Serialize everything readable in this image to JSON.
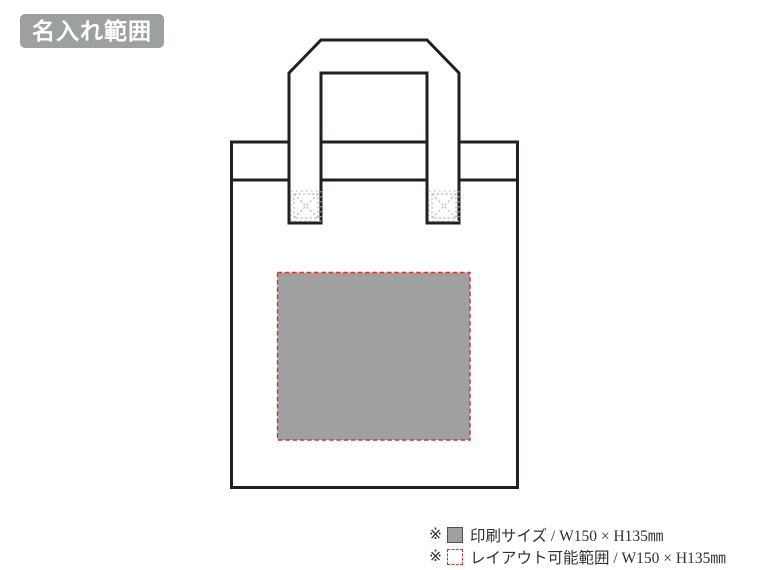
{
  "badge": {
    "label": "名入れ範囲"
  },
  "diagram": {
    "subject": "tote-bag",
    "colors": {
      "outline": "#231f20",
      "print_area_fill": "#a0a0a0",
      "layout_area_border": "#c9352e",
      "badge_background": "#9da0a0",
      "stitch_mark": "#bdbdbd"
    }
  },
  "legend": {
    "rows": [
      {
        "marker": "※",
        "icon": "print-size-swatch",
        "label": "印刷サイズ / W150 × H135㎜"
      },
      {
        "marker": "※",
        "icon": "layout-range-swatch",
        "label": "レイアウト可能範囲 / W150 × H135㎜"
      }
    ]
  }
}
